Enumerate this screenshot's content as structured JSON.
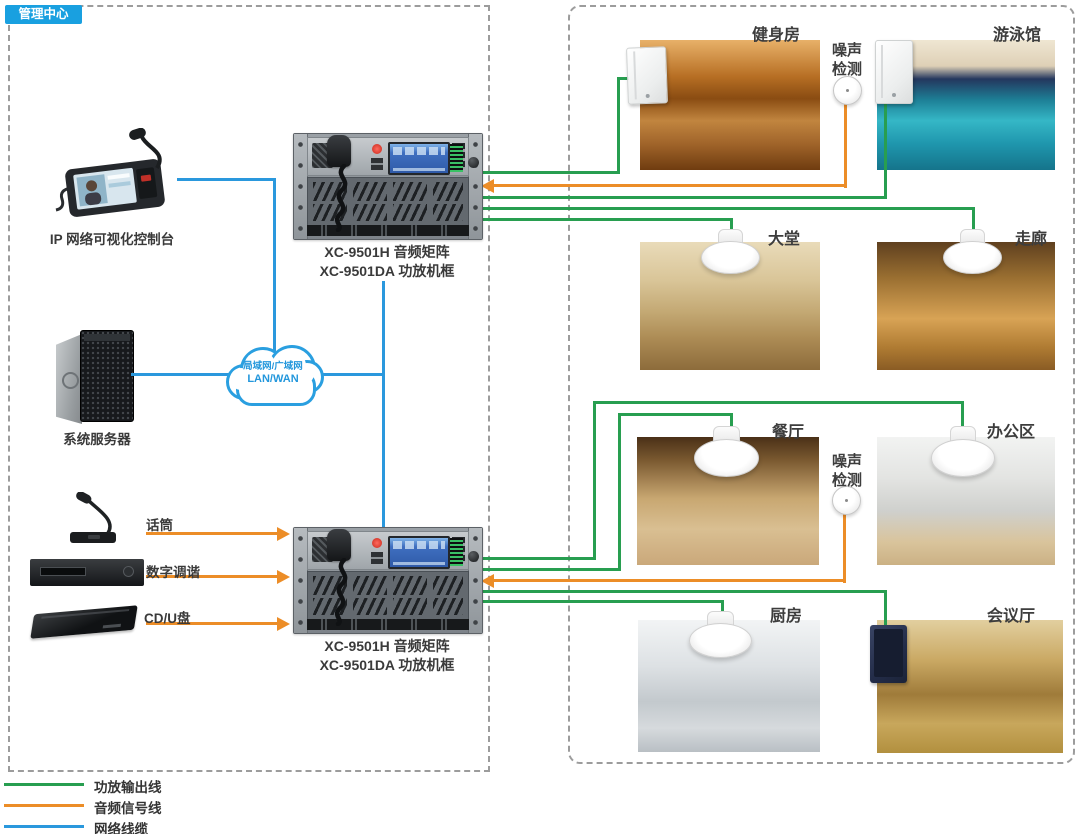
{
  "management_center": {
    "badge": "管理中心",
    "console": {
      "label": "IP 网络可视化控制台"
    },
    "rack_top": {
      "line1": "XC-9501H 音频矩阵",
      "line2": "XC-9501DA 功放机框"
    },
    "rack_bottom": {
      "line1": "XC-9501H 音频矩阵",
      "line2": "XC-9501DA 功放机框"
    },
    "server": {
      "label": "系统服务器"
    },
    "cloud": {
      "line1": "局域网/广域网",
      "line2": "LAN/WAN"
    },
    "sources": {
      "mic": "话筒",
      "tuner": "数字调谐",
      "cd": "CD/U盘"
    }
  },
  "zones": {
    "gym": {
      "label": "健身房"
    },
    "pool": {
      "label": "游泳馆"
    },
    "lobby": {
      "label": "大堂"
    },
    "corridor": {
      "label": "走廊"
    },
    "restaurant": {
      "label": "餐厅"
    },
    "office": {
      "label": "办公区"
    },
    "kitchen": {
      "label": "厨房"
    },
    "conference": {
      "label": "会议厅"
    },
    "noise_detect_top": {
      "label": "噪声检测"
    },
    "noise_detect_mid": {
      "label": "噪声检测"
    }
  },
  "legend": {
    "items": [
      {
        "label": "功放输出线",
        "color": "#289e50"
      },
      {
        "label": "音频信号线",
        "color": "#ec8d27"
      },
      {
        "label": "网络线缆",
        "color": "#2a98dd"
      }
    ]
  },
  "colors": {
    "amp_output_line": "#289e50",
    "audio_signal_line": "#ec8d27",
    "network_line": "#2a98dd",
    "badge_bg": "#19a0e0",
    "dashed_border": "#9c9c9c",
    "cloud_stroke": "#2a9fe0"
  }
}
